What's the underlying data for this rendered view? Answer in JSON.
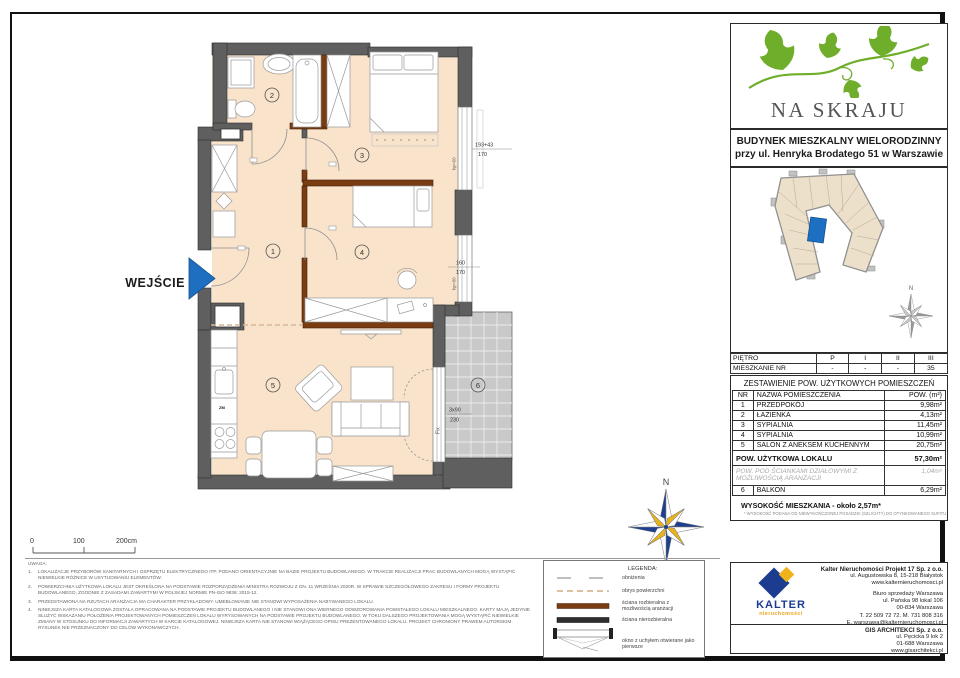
{
  "header": {
    "project_name": "NA SKRAJU",
    "building_line1": "BUDYNEK MIESZKALNY WIELORODZINNY",
    "building_line2": "przy ul. Henryka Brodatego 51 w Warszawie"
  },
  "floor_table": {
    "rows": [
      {
        "label": "PIĘTRO",
        "values": [
          "P",
          "I",
          "II",
          "III"
        ]
      },
      {
        "label": "MIESZKANIE NR",
        "values": [
          "-",
          "-",
          "-",
          "35"
        ]
      }
    ]
  },
  "area_table": {
    "title": "ZESTAWIENIE POW. UŻYTKOWYCH POMIESZCZEŃ",
    "col_nr": "NR",
    "col_name": "NAZWA POMIESZCZENIA",
    "col_area": "POW. (m²)",
    "rows": [
      {
        "nr": "1",
        "name": "PRZEDPOKÓJ",
        "area": "9,98m²"
      },
      {
        "nr": "2",
        "name": "ŁAZIENKA",
        "area": "4,13m²"
      },
      {
        "nr": "3",
        "name": "SYPIALNIA",
        "area": "11,45m²"
      },
      {
        "nr": "4",
        "name": "SYPIALNIA",
        "area": "10,99m²"
      },
      {
        "nr": "5",
        "name": "SALON Z ANEKSEM KUCHENNYM",
        "area": "20,75m²"
      }
    ],
    "total_label": "POW. UŻYTKOWA LOKALU",
    "total_area": "57,30m²",
    "partition_label": "POW. POD ŚCIANKAMI DZIAŁOWYMI Z MOŻLIWOŚCIĄ ARANŻACJI",
    "partition_area": "1,04m²",
    "balcony_nr": "6",
    "balcony_name": "BALKON",
    "balcony_area": "6,29m²",
    "height_label": "WYSOKOŚĆ MIESZKANIA - około 2,57m*",
    "height_note": "* WYSOKOŚĆ PODANA OD NIEWYKOŃCZONEJ POSADZKI (SZLICHTY) DO OTYNKOWANEGO SUFITU"
  },
  "plan": {
    "entrance_label": "WEJŚCIE",
    "rooms": [
      "1",
      "2",
      "3",
      "4",
      "5",
      "6"
    ],
    "dim_win1_top": "193+43",
    "dim_win1_bot": "170",
    "dim_win2_top": "160",
    "dim_win2_bot": "170",
    "dim_balcony_top": "3x90",
    "dim_balcony_bot": "230",
    "label_win1": "hp=60",
    "label_win2": "hp=80",
    "label_fix": "Fix",
    "label_hp0": "hp=0,0",
    "label_kitchen": "ZM",
    "compass_n": "N"
  },
  "scalebar": {
    "zero": "0",
    "hundred": "100",
    "twohundred": "200cm"
  },
  "legend": {
    "title": "LEGENDA:",
    "item1": "obniżenia",
    "item2": "obrys powierzchni",
    "item3": "ściana rozbieralna z możliwością aranżacji",
    "item4": "ściana nierozbieralna",
    "item5": "okno z uchyłem otwierane jako pierwsze"
  },
  "notes": {
    "title": "UWAGA:",
    "n1": "LOKALIZACJE PRZYBORÓW SANITARNYCH I OSPRZĘTU ELEKTRYCZNEGO ITP. PODANO ORIENTACYJNIE NA BAZIE PROJEKTU BUDOWLANEGO. W TRAKCIE REALIZACJI PRAC BUDOWLANYCH MOGĄ WYSTĄPIĆ NIEWIELKIE RÓŻNICE W USYTUOWANIU ELEMENTÓW.",
    "n2": "POWIERZCHNIA UŻYTKOWA LOKALU JEST OKREŚLONA NA PODSTAWIE ROZPORZĄDZENIA MINISTRA ROZWOJU Z DN. 11 WRZEŚNIA 2020R. W SPRAWIE SZCZEGÓŁOWEGO ZAKRESU I FORMY PROJEKTU BUDOWLANEGO, ZGODNIE Z ZASADAMI ZAWARTYMI W POLSKIEJ NORMIE PN-ISO 9836: 2015-12.",
    "n3": "PRZEDSTAWIONA NA RZUTACH ARANŻACJA MA CHARAKTER PRZYKŁADOWY. UMEBLOWANIE NIE STANOWI WYPOSAŻENIA NABYWANEGO LOKALU.",
    "n4": "NINIEJSZA KARTA KATALOGOWA ZOSTAŁA OPRACOWANA NA PODSTAWIE PROJEKTU BUDOWLANEGO I NIE STANOWI ONA WIERNEGO ODWZOROWANIA POWSTAŁEGO LOKALU MIESZKALNEGO. KARTY MAJĄ JEDYNIE SŁUŻYĆ WSKAZANIU POŁOŻENIA PROJEKTOWANYCH POMIESZCZEŃ LOKALU WYRYSOWANYCH NA PODSTAWIE PROJEKTU BUDOWLANEGO. W TOKU DALSZEGO PROJEKTOWANIA MOGĄ WYSTĄPIĆ NIEWIELKIE ZMIANY W STOSUNKU DO INFORMACJI ZAWARTYCH W KARCIE KATALOGOWEJ. NINIEJSZA KARTA NIE STANOWI WIĄŻĄCEGO OPISU PREZENTOWANEGO LOKALU. PROJEKT CHRONIONY PRAWEM AUTORSKIM. RYSUNEK NIE PRZEZNACZONY DO CELÓW WYKONAWCZYCH."
  },
  "contacts": {
    "kalter_name": "KALTER",
    "kalter_sub": "nieruchomości",
    "title": "Kalter Nieruchomości Projekt 17 Sp. z o.o.",
    "addr1": "ul. Augustowska 8, 15-218 Białystok",
    "addr2": "www.kalternieruchomosci.pl",
    "office_title": "Biuro sprzedaży Warszawa",
    "office1": "ul. Pańska 98 lokal 106",
    "office2": "00-834 Warszawa",
    "office3": "T. 22 509 72 72. M. 731 808 316",
    "office4": "E. warszawa@kalternieruchomosci.pl",
    "gis_title": "GIS ARCHITEKCI Sp. z o.o.",
    "gis1": "ul. Pęcicka 9 lok 2",
    "gis2": "01-688 Warszawa",
    "gis3": "www.gisarchitekci.pl"
  },
  "colors": {
    "accent_blue": "#1e6fc0",
    "ivy_green": "#6fae2b",
    "kalter_navy": "#1b3c8f",
    "kalter_yellow": "#f0b31c",
    "wall_gray": "#5f5f5f",
    "floor_peach": "#f9e3cb",
    "removable_wall_brown": "#7a3d12",
    "balcony_gray": "#c9c9c9"
  }
}
